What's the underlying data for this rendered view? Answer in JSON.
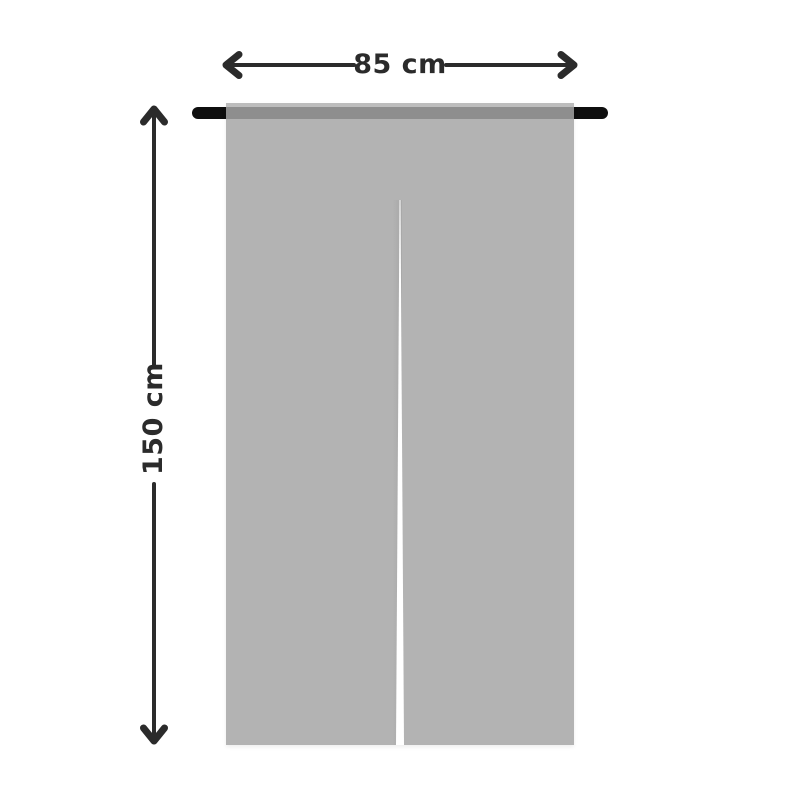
{
  "diagram": {
    "type": "product-dimension-diagram",
    "subject": "split door curtain (noren) hanging on a rod",
    "width_label": "85 cm",
    "height_label": "150 cm",
    "colors": {
      "background": "#ffffff",
      "arrow_and_text": "#2b2b2b",
      "rod": "#0f0f0f",
      "curtain": "#b3b3b3",
      "curtain_top_hem": "#bdbdbd",
      "rod_through_fabric": "#8e8e8e",
      "split": "#ffffff"
    }
  }
}
